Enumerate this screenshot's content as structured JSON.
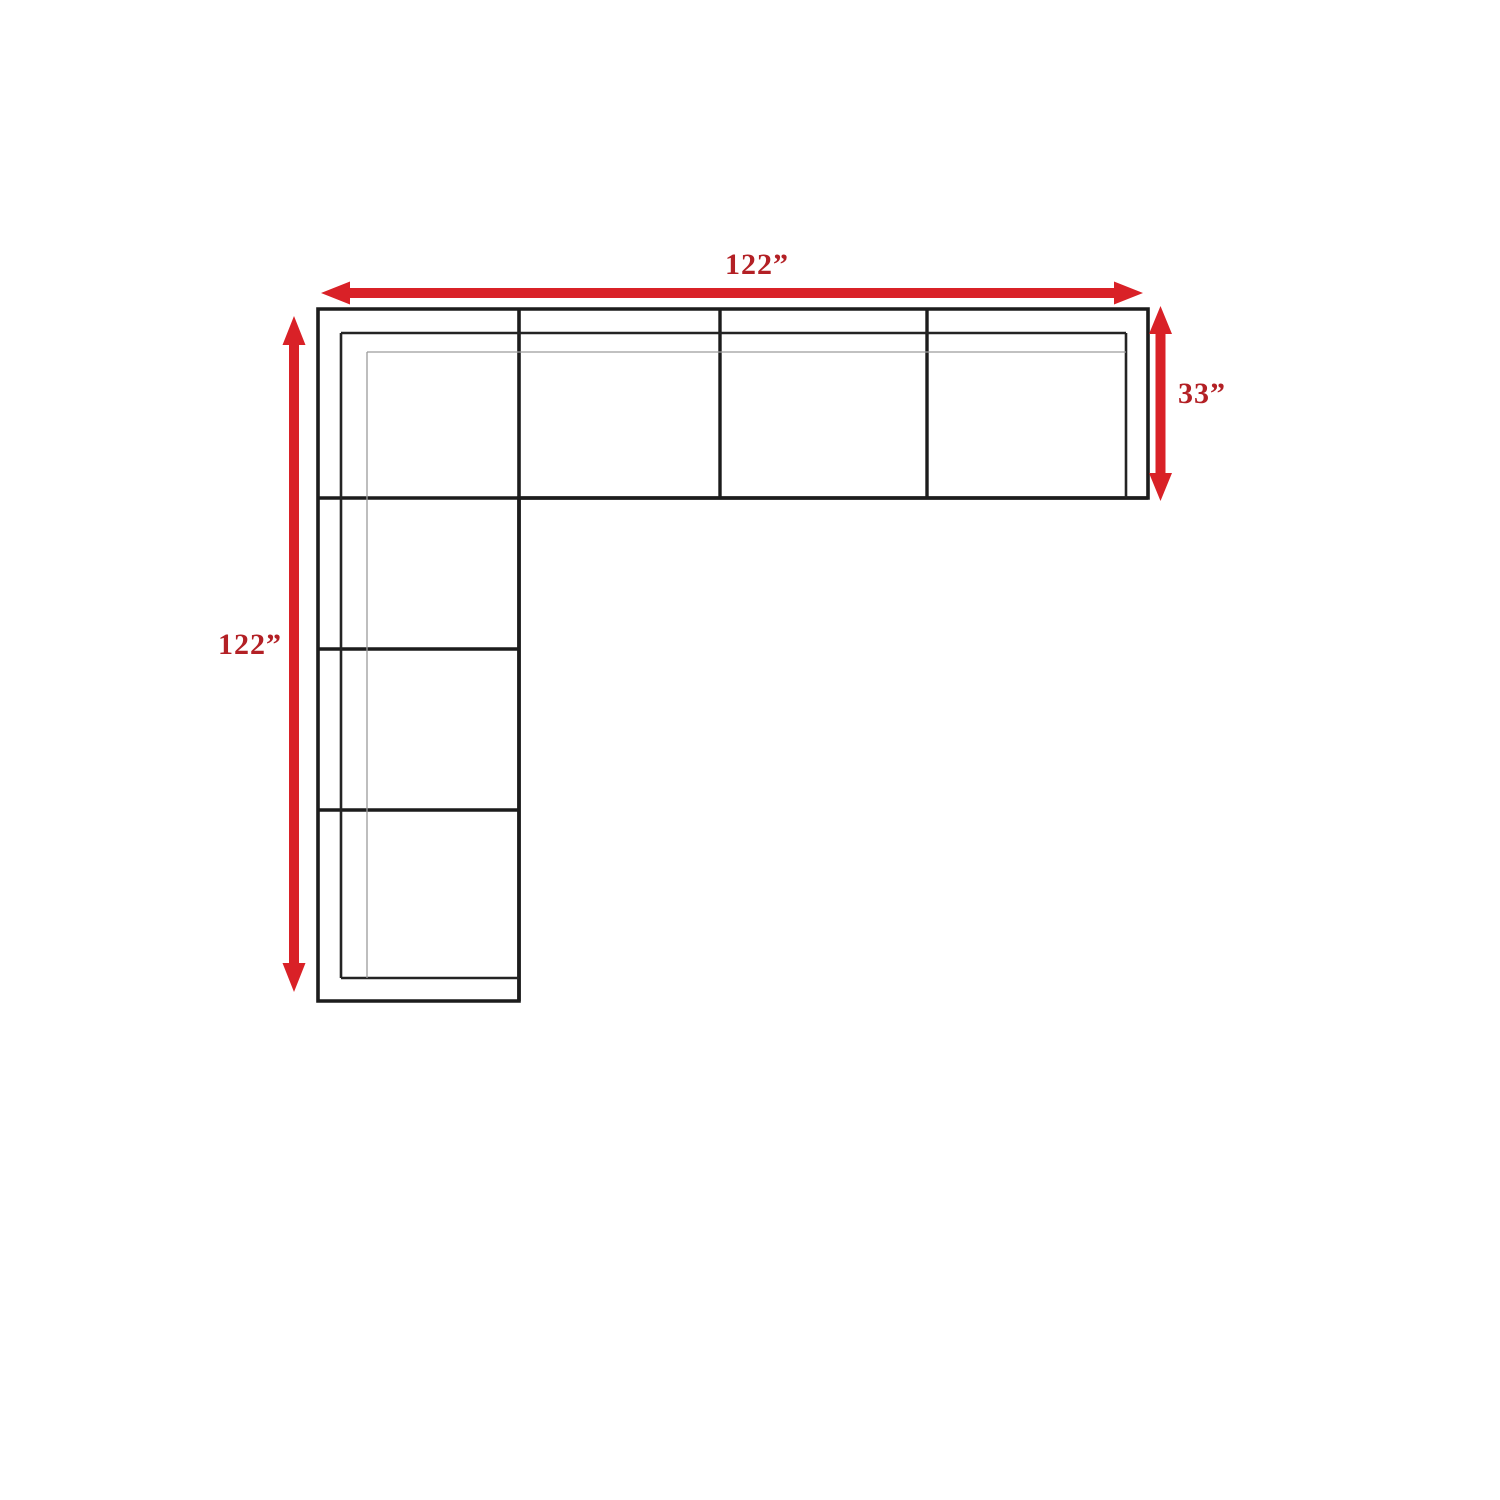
{
  "diagram": {
    "type": "sectional-sofa-dimension-diagram",
    "description": "Top view outline of an L-shaped sectional sofa with red dimension arrows",
    "labels": {
      "top_width": "122”",
      "right_depth": "33”",
      "left_length": "122”"
    },
    "sections": {
      "horizontal_bar_seats": 4,
      "vertical_bar_seats": 4
    }
  },
  "colors": {
    "background": "#ffffff",
    "arrow": "#d92127",
    "label_text": "#b32025",
    "outline": "#1c1c1c",
    "seam_line": "#1c1c1c",
    "inner_line": "#242424",
    "thin_line": "#9c9c9c"
  },
  "icons": {
    "top_arrow": "double-headed-horizontal-arrow-icon",
    "right_arrow": "double-headed-vertical-arrow-icon",
    "left_arrow": "double-headed-vertical-arrow-icon"
  }
}
